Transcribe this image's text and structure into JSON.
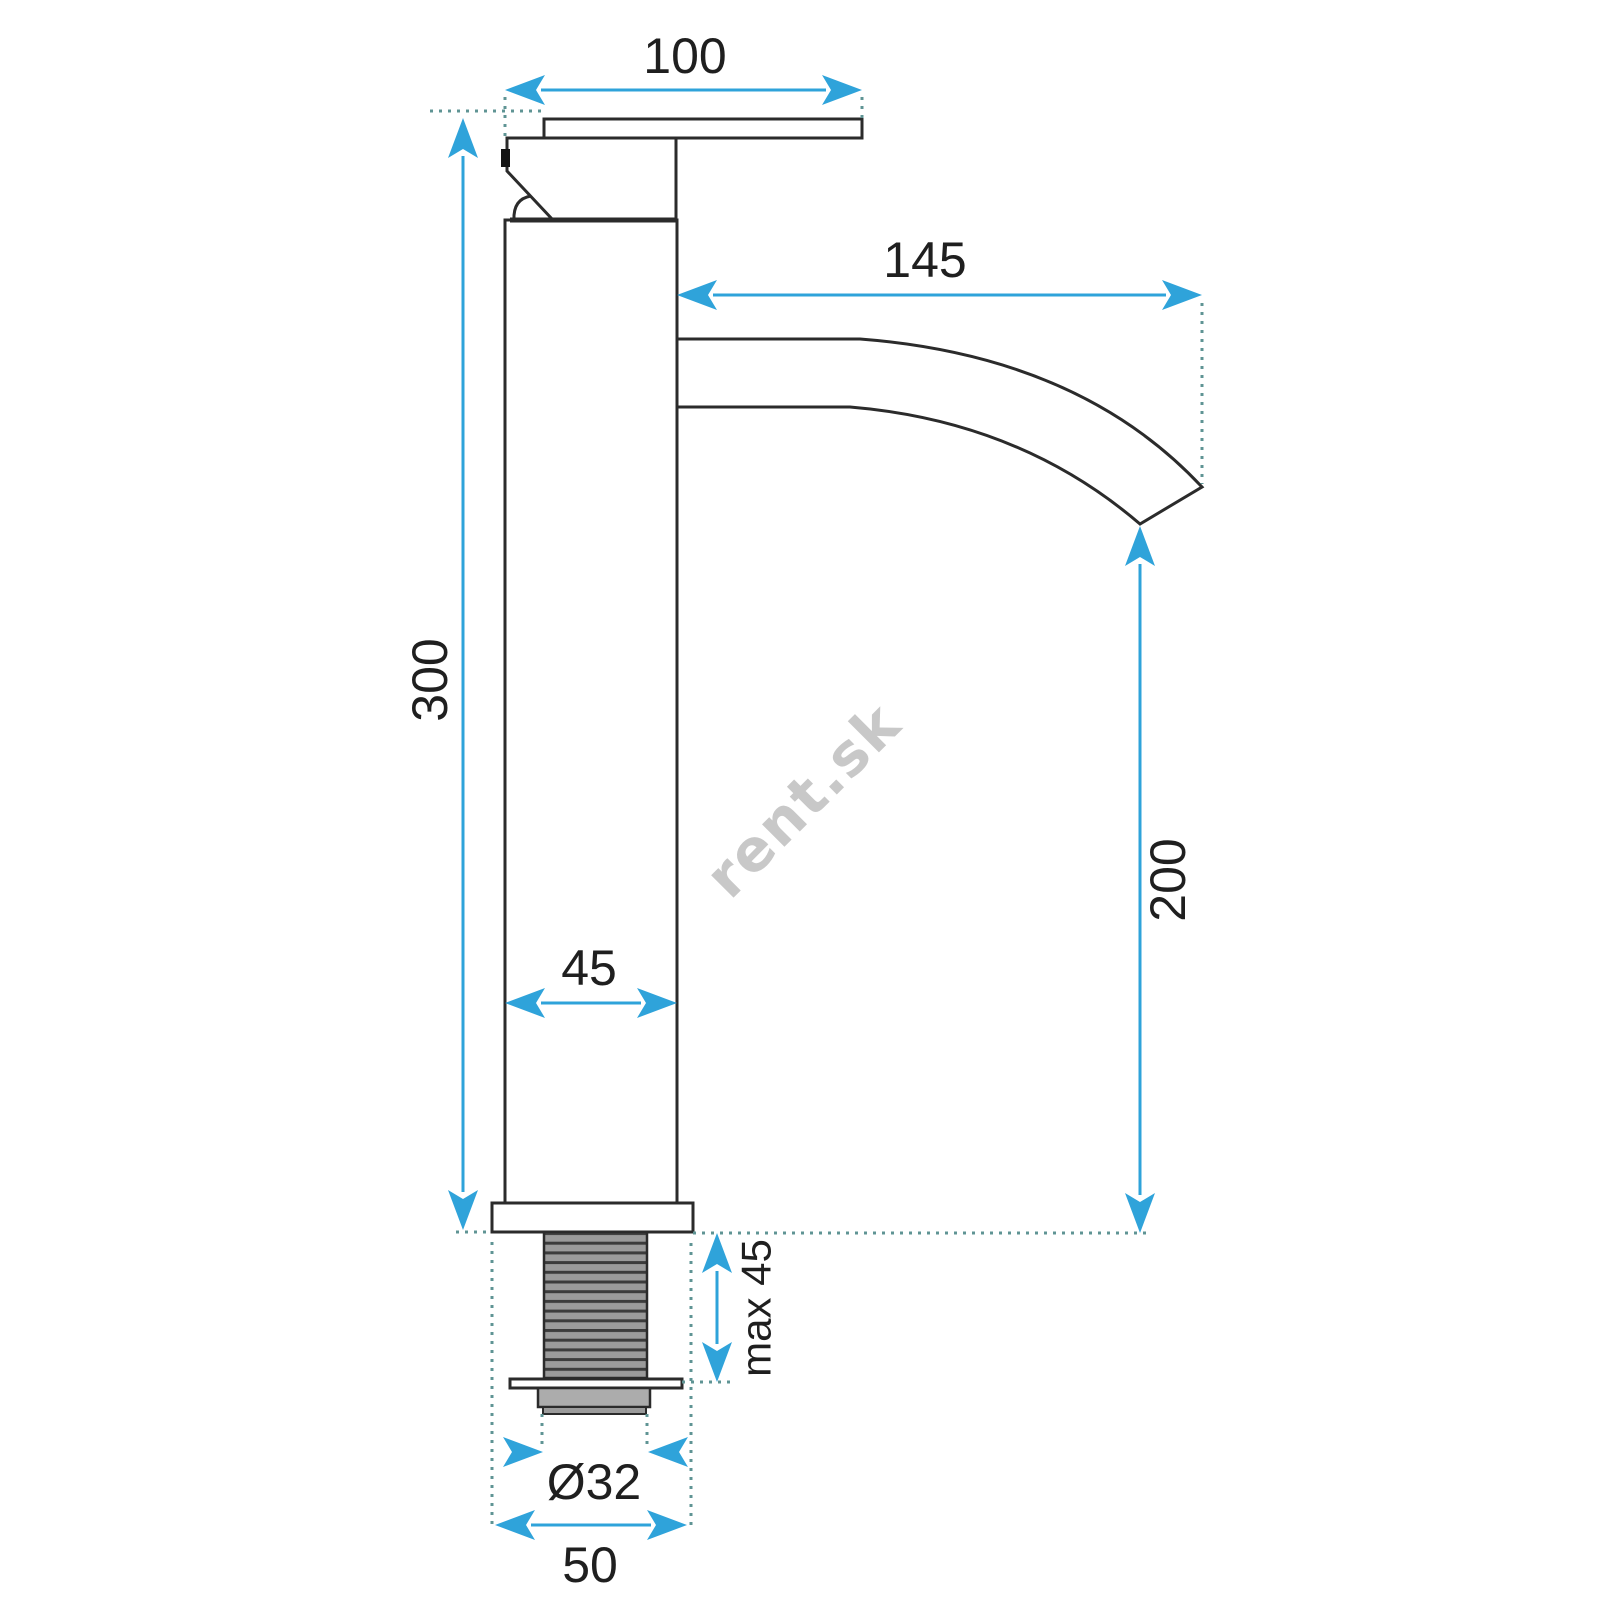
{
  "drawing": {
    "type": "technical-dimension-drawing",
    "subject": "tall single-lever basin faucet, side view"
  },
  "dimensions": {
    "handle_width": "100",
    "spout_reach": "145",
    "body_height": "300",
    "spout_outlet_height": "200",
    "body_diameter": "45",
    "max_mount_thickness": "max 45",
    "thread_diameter": "Ø32",
    "base_diameter": "50"
  },
  "watermark": "rent.sk",
  "colors": {
    "dimension_blue": "#2fa3da",
    "extension_teal": "#5f9494",
    "outline_dark": "#2b2b2b",
    "thread_gray": "#9b9b9b",
    "stripe_dark": "#3c3c3c",
    "nut_gray": "#acacac",
    "watermark_gray": "#c8c8c8",
    "label_dark": "#1f1f1f",
    "background": "#ffffff"
  }
}
